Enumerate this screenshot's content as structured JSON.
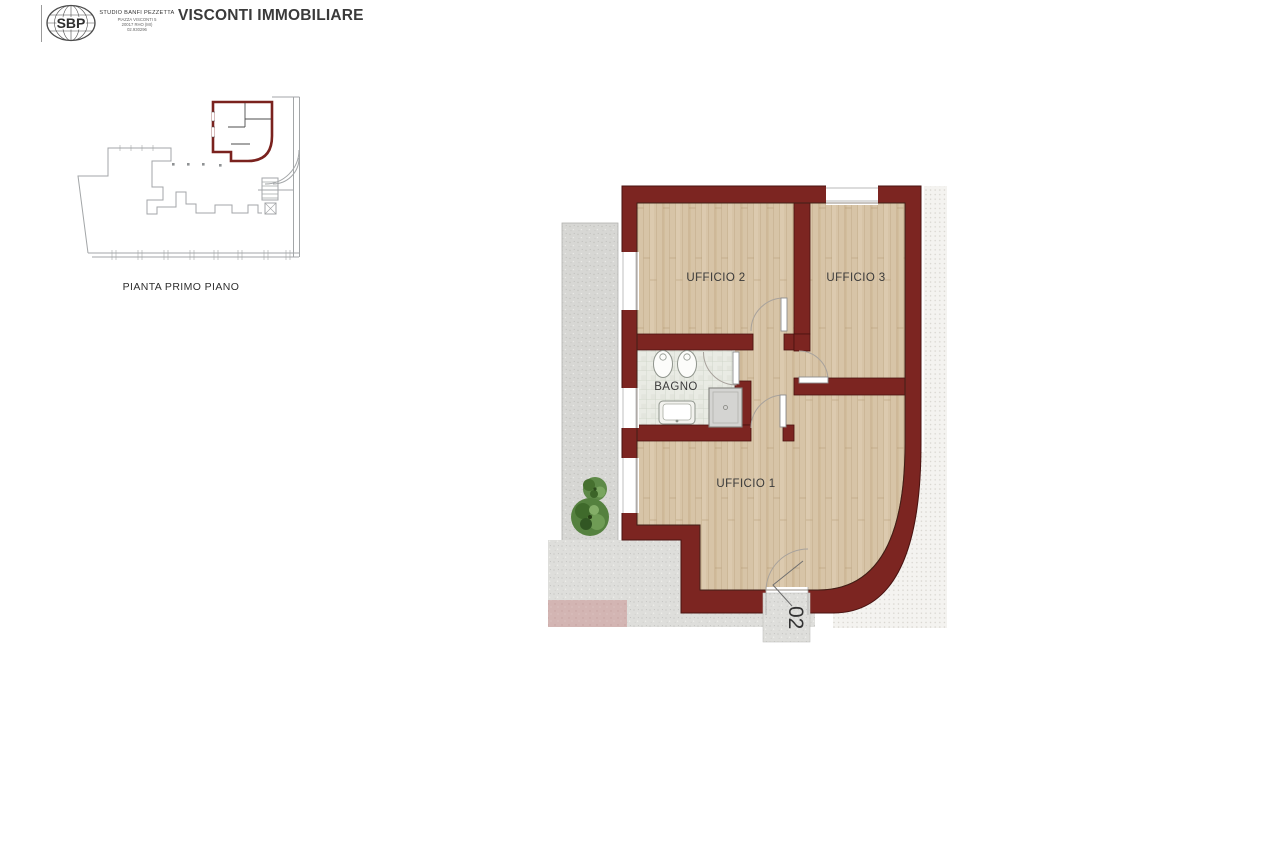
{
  "header": {
    "logo": {
      "text": "SBP",
      "icon": "globe-ellipse"
    },
    "studio": {
      "name": "STUDIO BANFI PEZZETTA",
      "address_line1": "PIAZZA VISCONTI 5",
      "address_line2": "20017 RHO (MI)",
      "address_line3": "02.930296"
    },
    "title": "VISCONTI IMMOBILIARE"
  },
  "key_plan": {
    "caption": "PIANTA PRIMO PIANO"
  },
  "floor_plan": {
    "rooms": [
      {
        "label": "UFFICIO 2"
      },
      {
        "label": "UFFICIO 3"
      },
      {
        "label": "BAGNO"
      },
      {
        "label": "UFFICIO 1"
      }
    ],
    "entrance_label": "02",
    "colors": {
      "wall": "#7c2521",
      "wall_outline": "#491210",
      "wood_floor": "#d7c4a7",
      "tile_floor": "#e9ebe4",
      "terrace": "#d7d7d4",
      "paving": "#dededb",
      "pink_area": "#d3b5b3",
      "tree_green": "#55813f",
      "label_text": "#3a3a3a"
    }
  }
}
